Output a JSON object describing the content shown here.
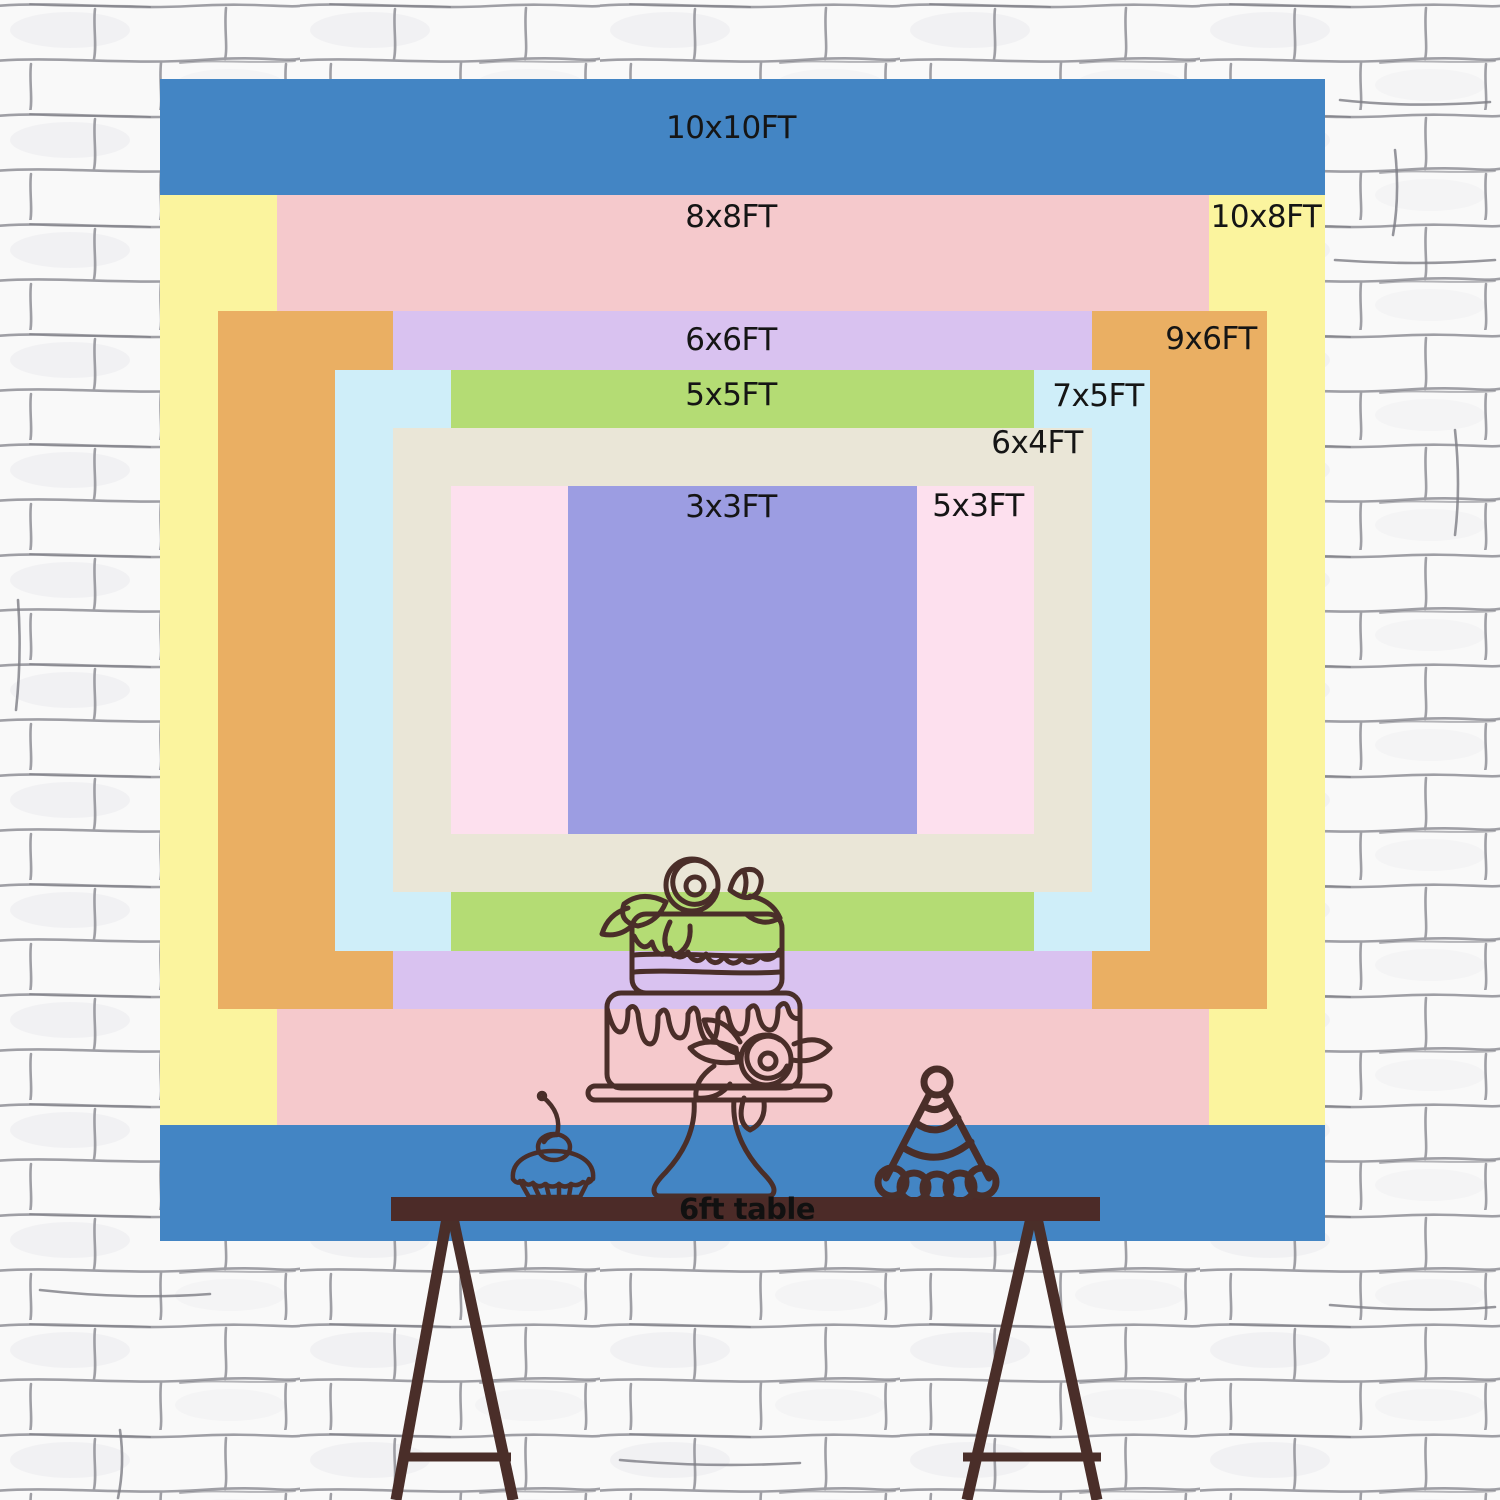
{
  "backdrop": {
    "origin": {
      "left": 160,
      "top": 79
    },
    "width": 1165,
    "height": 1162,
    "px_per_ft": {
      "x": 116.5,
      "y": 116.2
    },
    "center": {
      "x": 582.5,
      "y": 581
    },
    "label_color": "#151515",
    "sizes": [
      {
        "label": "10x10FT",
        "w_ft": 10,
        "h_ft": 10,
        "color": "#4385c4",
        "label_x": 571,
        "label_y": 49
      },
      {
        "label": "10x8FT",
        "w_ft": 10,
        "h_ft": 8,
        "color": "#fbf49e",
        "label_x": 1106,
        "label_y": 138
      },
      {
        "label": "8x8FT",
        "w_ft": 8,
        "h_ft": 8,
        "color": "#f5c9cc",
        "label_x": 571,
        "label_y": 138
      },
      {
        "label": "9x6FT",
        "w_ft": 9,
        "h_ft": 6,
        "color": "#eaaf63",
        "label_x": 1051,
        "label_y": 260
      },
      {
        "label": "6x6FT",
        "w_ft": 6,
        "h_ft": 6,
        "color": "#d9c2f0",
        "label_x": 571,
        "label_y": 261
      },
      {
        "label": "7x5FT",
        "w_ft": 7,
        "h_ft": 5,
        "color": "#cfeef9",
        "label_x": 938,
        "label_y": 317
      },
      {
        "label": "5x5FT",
        "w_ft": 5,
        "h_ft": 5,
        "color": "#b4dc74",
        "label_x": 571,
        "label_y": 316
      },
      {
        "label": "6x4FT",
        "w_ft": 6,
        "h_ft": 4,
        "color": "#eae6d7",
        "label_x": 877,
        "label_y": 364
      },
      {
        "label": "5x3FT",
        "w_ft": 5,
        "h_ft": 3,
        "color": "#fde0ee",
        "label_x": 818,
        "label_y": 427
      },
      {
        "label": "3x3FT",
        "w_ft": 3,
        "h_ft": 3,
        "color": "#9c9de2",
        "label_x": 571,
        "label_y": 428
      }
    ]
  },
  "table": {
    "label": "6ft table",
    "color": "#4c2b28",
    "label_color": "#111111"
  },
  "artwork": {
    "stroke": "#4a2e29",
    "items": [
      "tiered-cake",
      "cupcake-with-cherry",
      "party-hat"
    ]
  },
  "wall": {
    "base_color": "#f9f9f9",
    "line_color": "#8f8f97"
  }
}
